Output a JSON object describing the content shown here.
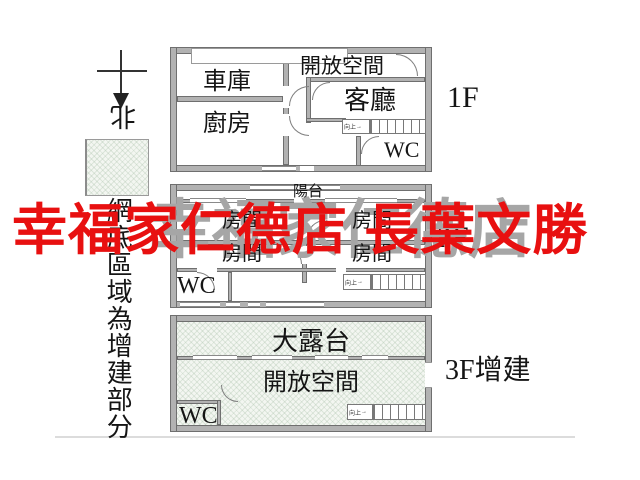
{
  "watermark": {
    "red_text": "幸福家仁德店 長葉文勝",
    "red_color": "#e81010",
    "gray_text": "幸福家仁德店",
    "gray_color": "#a6a6a6"
  },
  "legend": {
    "north_label": "北",
    "note_vertical": "網底區域為增建部分"
  },
  "common": {
    "wc": "WC",
    "stairs_up": "向上",
    "stairs_arrow": "→"
  },
  "floor1": {
    "label": "1F",
    "garage": "車庫",
    "kitchen": "廚房",
    "open_space": "開放空間",
    "living_room": "客廳"
  },
  "floor2": {
    "label": "2F",
    "balcony": "陽台",
    "room": "房間"
  },
  "floor3": {
    "label": "3F增建",
    "terrace": "大露台",
    "open_space": "開放空間"
  }
}
